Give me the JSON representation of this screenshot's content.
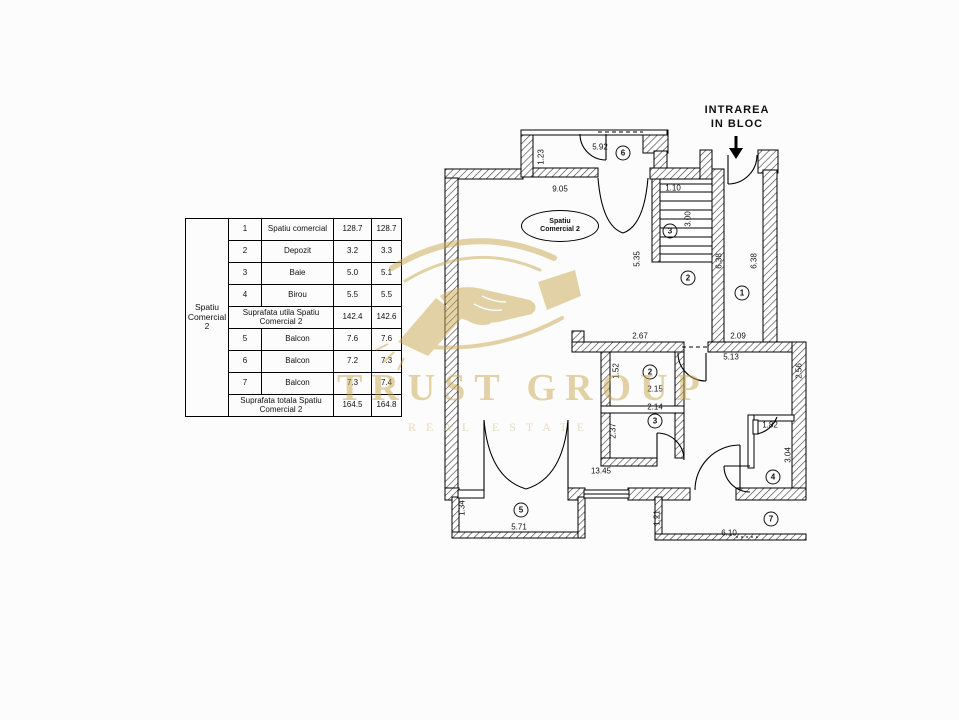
{
  "table": {
    "group_label": "Spatiu Comercial 2",
    "rows": [
      {
        "num": "1",
        "name": "Spatiu comercial",
        "a1": "128.7",
        "a2": "128.7"
      },
      {
        "num": "2",
        "name": "Depozit",
        "a1": "3.2",
        "a2": "3.3"
      },
      {
        "num": "3",
        "name": "Baie",
        "a1": "5.0",
        "a2": "5.1"
      },
      {
        "num": "4",
        "name": "Birou",
        "a1": "5.5",
        "a2": "5.5"
      },
      {
        "name": "Suprafata utila Spatiu Comercial 2",
        "a1": "142.4",
        "a2": "142.6"
      },
      {
        "num": "5",
        "name": "Balcon",
        "a1": "7.6",
        "a2": "7.6"
      },
      {
        "num": "6",
        "name": "Balcon",
        "a1": "7.2",
        "a2": "7.3"
      },
      {
        "num": "7",
        "name": "Balcon",
        "a1": "7.3",
        "a2": "7.4"
      },
      {
        "name": "Suprafata totala Spatiu Comercial 2",
        "a1": "164.5",
        "a2": "164.8"
      }
    ]
  },
  "plan": {
    "entrance_label_line1": "INTRAREA",
    "entrance_label_line2": "IN BLOC",
    "room_oval_line1": "Spatiu",
    "room_oval_line2": "Comercial 2",
    "room_numbers": [
      {
        "n": "6",
        "x": 623,
        "y": 153
      },
      {
        "n": "3",
        "x": 670,
        "y": 231
      },
      {
        "n": "2",
        "x": 688,
        "y": 278
      },
      {
        "n": "1",
        "x": 742,
        "y": 293
      },
      {
        "n": "2",
        "x": 650,
        "y": 372
      },
      {
        "n": "3",
        "x": 655,
        "y": 421
      },
      {
        "n": "4",
        "x": 773,
        "y": 477
      },
      {
        "n": "5",
        "x": 521,
        "y": 510
      },
      {
        "n": "7",
        "x": 771,
        "y": 519
      }
    ],
    "dimensions": [
      {
        "t": "5.92",
        "x": 600,
        "y": 147,
        "r": 0
      },
      {
        "t": "1.23",
        "x": 541,
        "y": 157,
        "r": 1
      },
      {
        "t": "9.05",
        "x": 560,
        "y": 189,
        "r": 0
      },
      {
        "t": "1.10",
        "x": 673,
        "y": 188,
        "r": 0
      },
      {
        "t": "3.00",
        "x": 688,
        "y": 219,
        "r": 1
      },
      {
        "t": "5.35",
        "x": 637,
        "y": 259,
        "r": 1
      },
      {
        "t": "6.38",
        "x": 719,
        "y": 261,
        "r": 1
      },
      {
        "t": "6.38",
        "x": 754,
        "y": 261,
        "r": 1
      },
      {
        "t": "2.67",
        "x": 640,
        "y": 336,
        "r": 0
      },
      {
        "t": "2.09",
        "x": 738,
        "y": 336,
        "r": 0
      },
      {
        "t": "5.13",
        "x": 731,
        "y": 357,
        "r": 0
      },
      {
        "t": "1.52",
        "x": 616,
        "y": 371,
        "r": 1
      },
      {
        "t": "2.15",
        "x": 655,
        "y": 389,
        "r": 0
      },
      {
        "t": "2.14",
        "x": 655,
        "y": 407,
        "r": 0
      },
      {
        "t": "2.37",
        "x": 613,
        "y": 431,
        "r": 1
      },
      {
        "t": "2.56",
        "x": 799,
        "y": 371,
        "r": 1
      },
      {
        "t": "1.82",
        "x": 770,
        "y": 425,
        "r": 0
      },
      {
        "t": "3.04",
        "x": 788,
        "y": 455,
        "r": 1
      },
      {
        "t": "13.45",
        "x": 601,
        "y": 471,
        "r": 0
      },
      {
        "t": "1.34",
        "x": 462,
        "y": 508,
        "r": 1
      },
      {
        "t": "5.71",
        "x": 519,
        "y": 527,
        "r": 0
      },
      {
        "t": "1.21",
        "x": 657,
        "y": 518,
        "r": 1
      },
      {
        "t": "6.10",
        "x": 729,
        "y": 533,
        "r": 0
      }
    ]
  },
  "watermark": {
    "title": "TRUST GROUP",
    "subtitle": "REAL ESTATE",
    "gold": "#c9a851"
  }
}
